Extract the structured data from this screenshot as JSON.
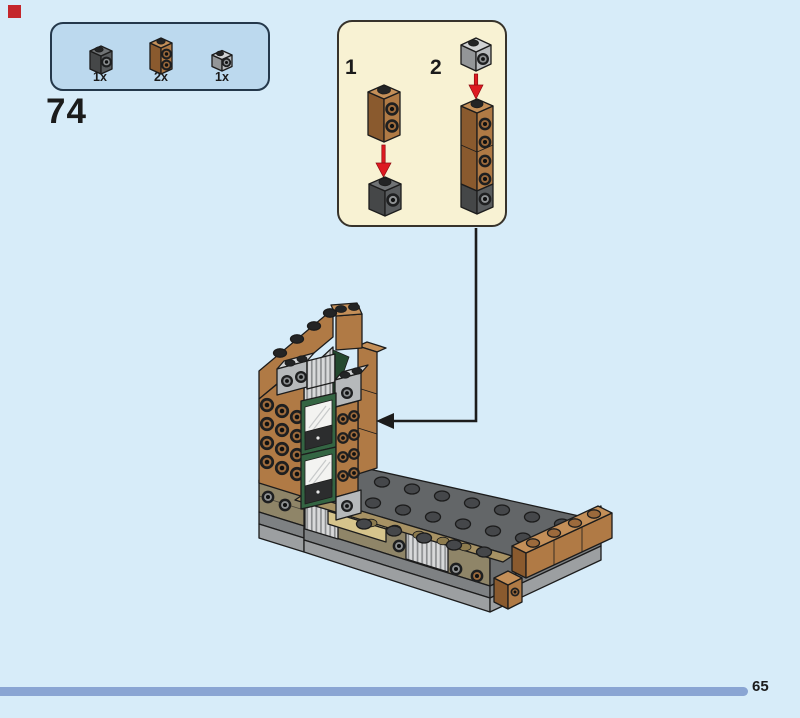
{
  "page": {
    "step_number": "74",
    "page_number": "65"
  },
  "parts_panel": {
    "items": [
      {
        "part": "dark-gray 1x1 brick with side stud",
        "count": "1x"
      },
      {
        "part": "medium-nougat 1x1x2 brick with two side studs",
        "count": "2x"
      },
      {
        "part": "light-gray 1x1 brick with side stud",
        "count": "1x"
      }
    ]
  },
  "callout": {
    "substeps": [
      {
        "label": "1"
      },
      {
        "label": "2"
      }
    ]
  },
  "colors": {
    "bg": "#d7ecf9",
    "marker_red": "#c4262c",
    "panel_bg": "#bcd9ee",
    "panel_border": "#24384b",
    "substep_bg": "#f8f2d3",
    "substep_border": "#37332b",
    "text": "#1b1b1b",
    "arrow_red": "#dd1a21",
    "outline": "#1c1c1c",
    "progress_bar": "#8aa5d3",
    "brown": "#b07a45",
    "brown_top": "#c48f58",
    "brown_dark": "#8a5a2e",
    "brown_stud": "#9c6a3c",
    "dkgray": "#595c5e",
    "dkgray_top": "#707375",
    "dkgray_dark": "#454748",
    "ltgray": "#b6b9bb",
    "ltgray_top": "#d0d2d3",
    "ltgray_dark": "#939698",
    "green": "#346543",
    "green_dark": "#24492f",
    "pane": "#f3f3f1",
    "sill": "#2c2d2e",
    "tan": "#d6c48c",
    "tan_light": "#e3d49e",
    "tan_plate": "#a79264",
    "tan_stud": "#8d7b4e",
    "dktan": "#8f8568",
    "base_gray": "#7e8183",
    "base_light": "#9c9fa1",
    "base_right": "#6b6e70",
    "plate_gray": "#636668",
    "plate_stud": "#45474a",
    "rib_light": "#d8d9da",
    "rib_dark": "#8b8d8f",
    "stud_black": "#232425"
  }
}
